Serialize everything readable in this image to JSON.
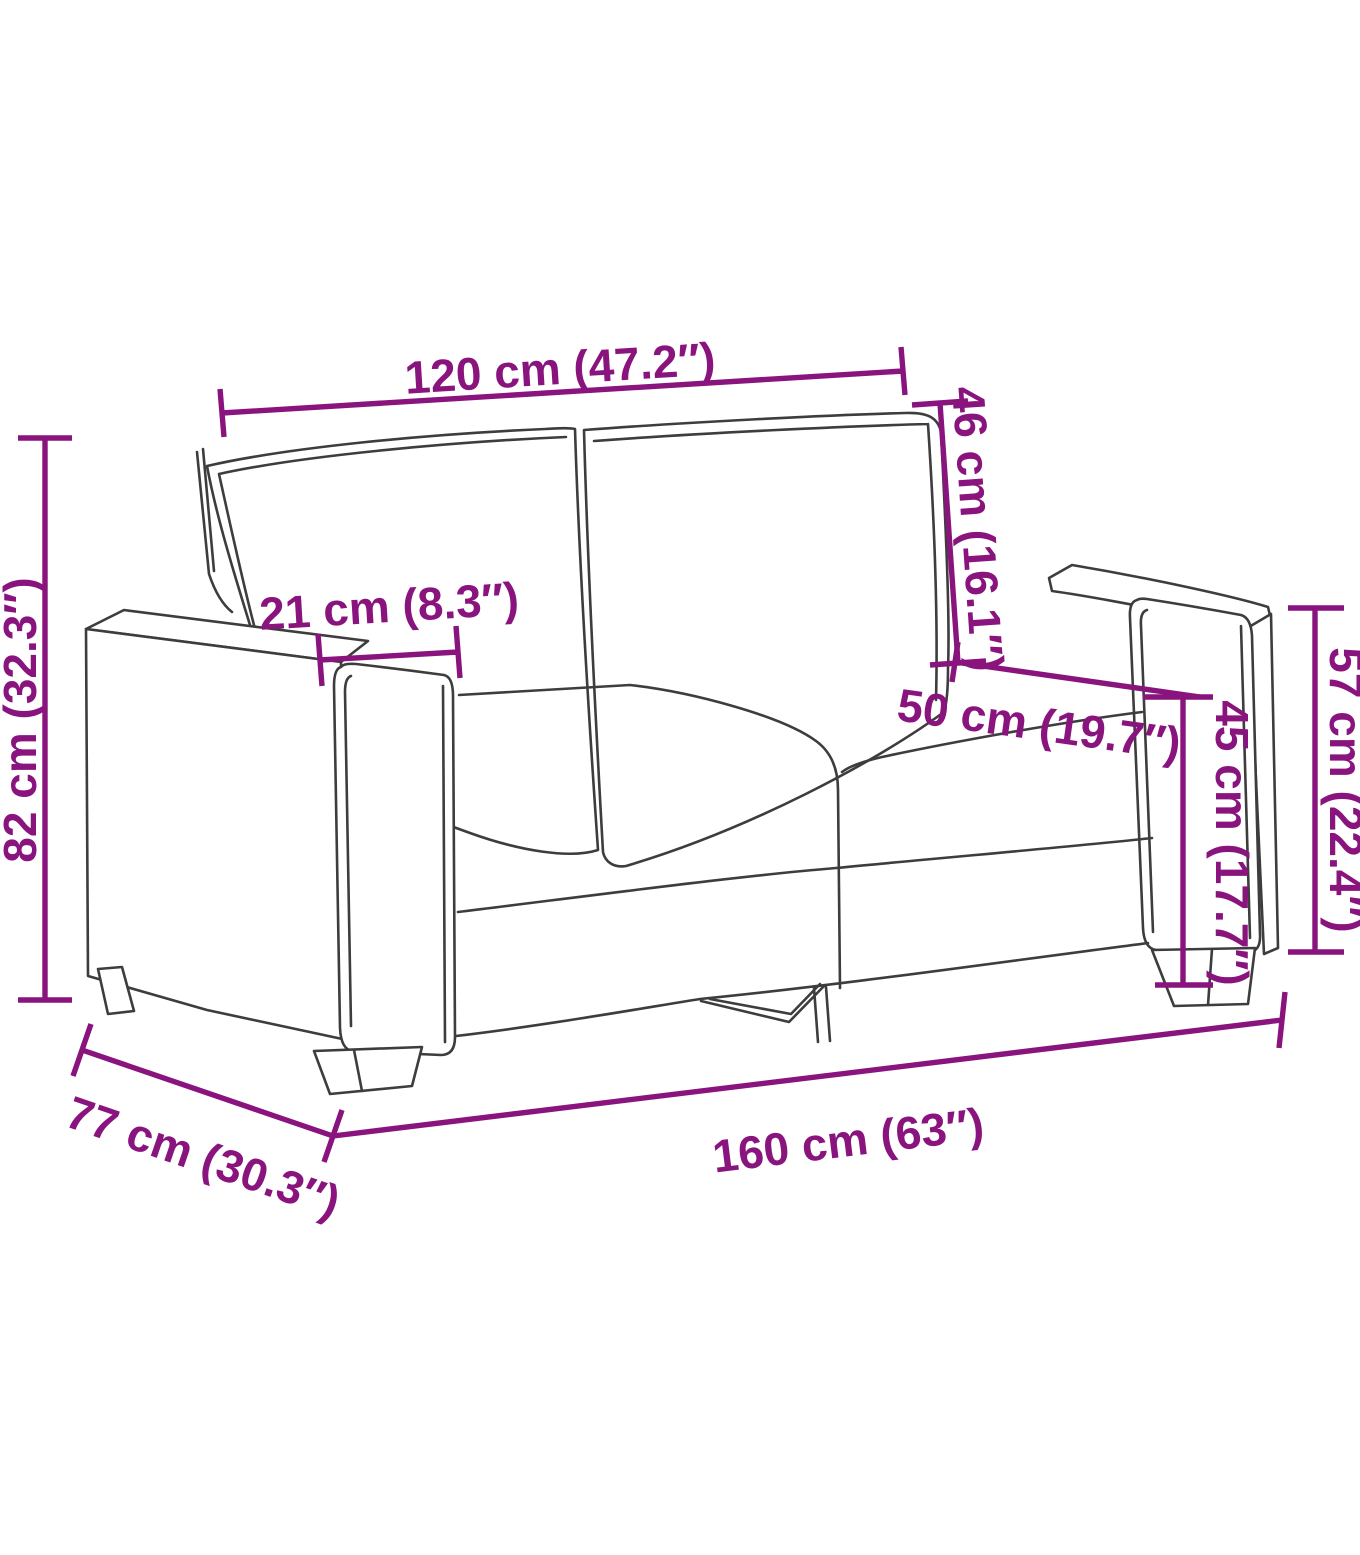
{
  "diagram": {
    "title": "sofa-dimension-diagram",
    "measurements": {
      "seat_width": "120 cm (47.2″)",
      "backrest_height": "46 cm (16.1″)",
      "total_height": "82 cm (32.3″)",
      "armrest_width": "21 cm (8.3″)",
      "seat_depth": "50 cm (19.7″)",
      "seat_height": "45 cm (17.7″)",
      "armrest_height": "57 cm (22.4″)",
      "total_depth": "77 cm (30.3″)",
      "total_width": "160 cm (63″)"
    },
    "colors": {
      "dimension_annotation": "#8a147e",
      "line_art": "#3d3d3d",
      "background": "#ffffff"
    }
  }
}
